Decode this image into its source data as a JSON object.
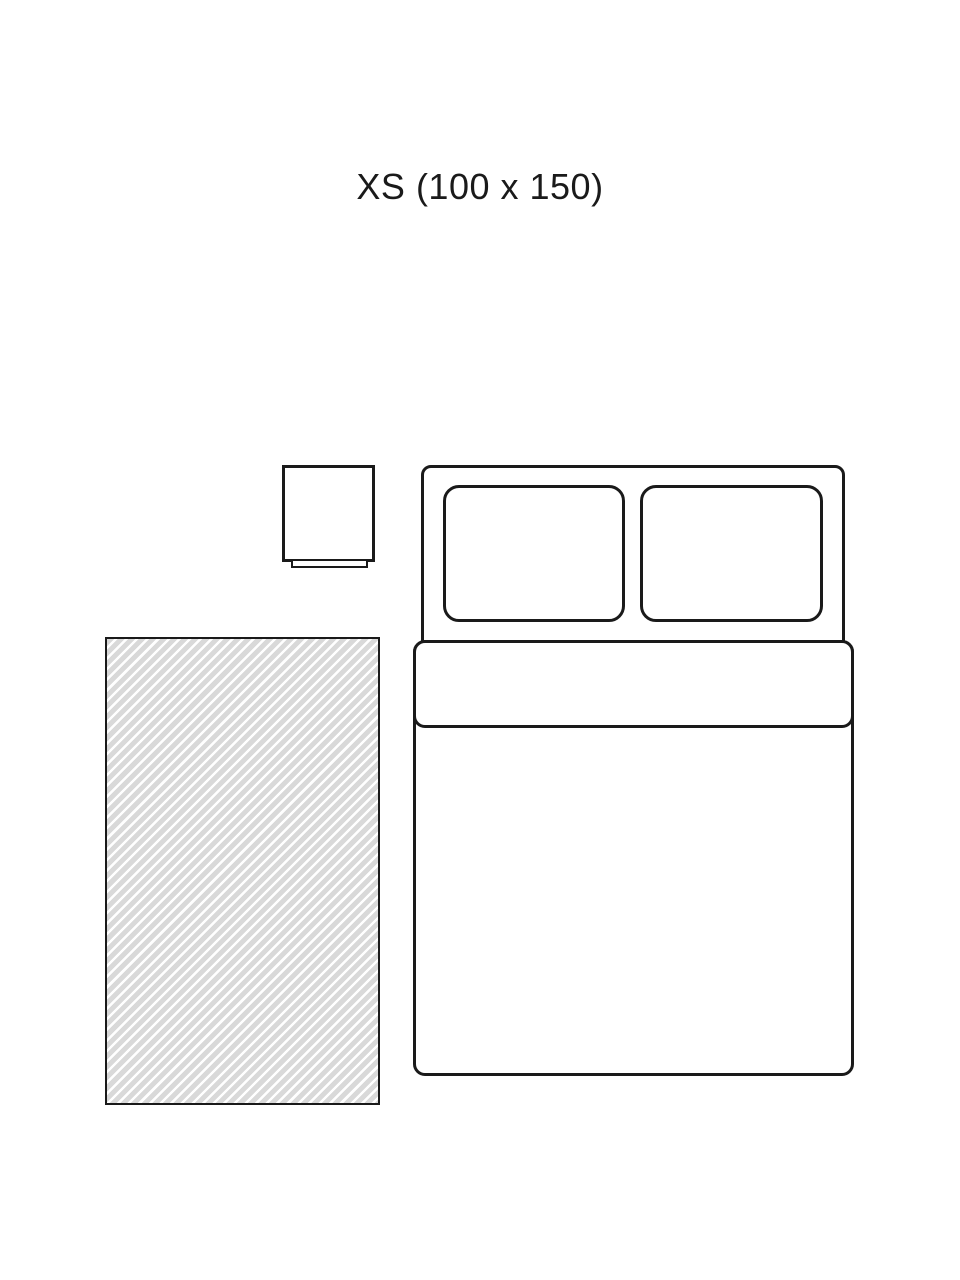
{
  "title": {
    "text": "XS (100 x 150)"
  },
  "colors": {
    "background": "#ffffff",
    "line": "#1a1a1a",
    "rug_base": "#d9d9d9",
    "rug_stripe": "#ffffff"
  },
  "diagram": {
    "objects": [
      {
        "name": "rug",
        "pattern": "diagonal-stripes"
      },
      {
        "name": "double-bed-with-two-pillows-and-duvet"
      },
      {
        "name": "nightstand"
      }
    ]
  }
}
